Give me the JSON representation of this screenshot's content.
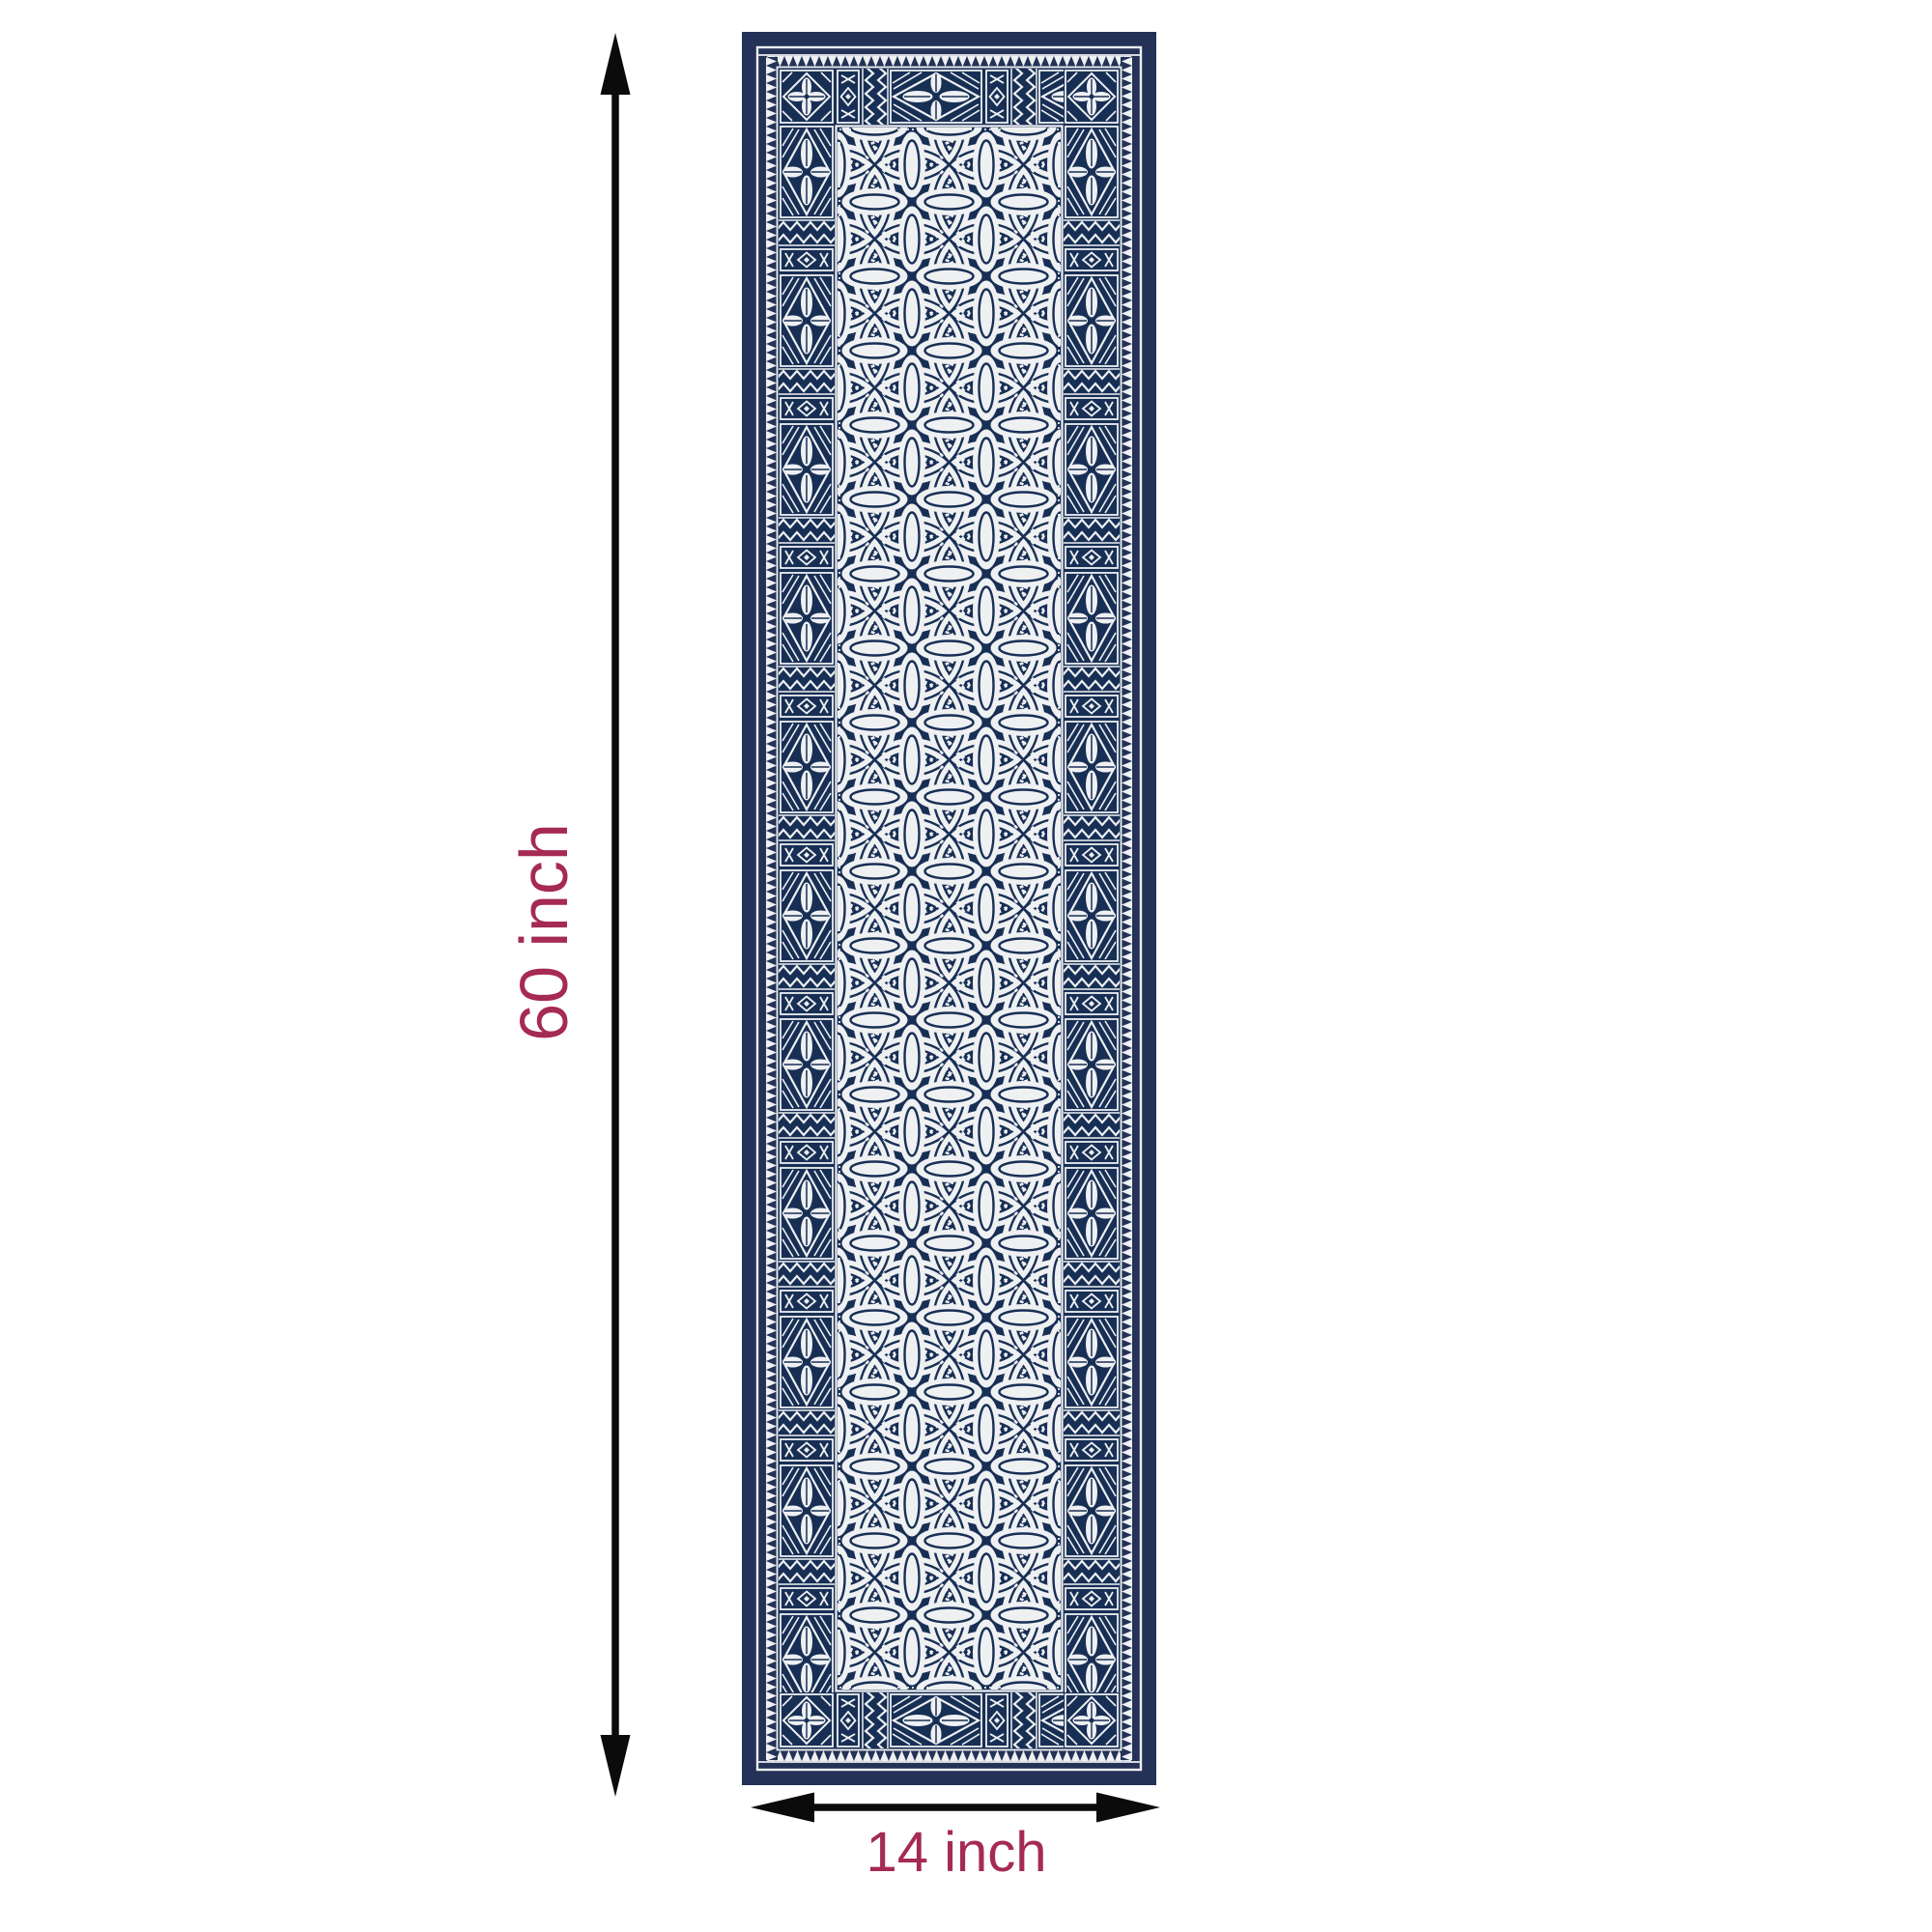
{
  "page": {
    "background_color": "#ffffff"
  },
  "product_image": {
    "description": "Navy blue and white geometric tapa-style table runner shown flat",
    "pattern": "overlapping-circle lattice field with tiled geometric border (quatrefoil diamonds, zigzags, diamond-and-X bands, sawtooth edging)",
    "colors": {
      "navy": "#233256",
      "navy_deep": "#182f55",
      "pattern_white": "#eef0f2"
    }
  },
  "dimensions": {
    "height": {
      "label": "60 inch",
      "value": 60,
      "unit": "inch"
    },
    "width": {
      "label": "14 inch",
      "value": 14,
      "unit": "inch"
    },
    "label_color": "#a52a55",
    "arrow_color": "#000000"
  }
}
